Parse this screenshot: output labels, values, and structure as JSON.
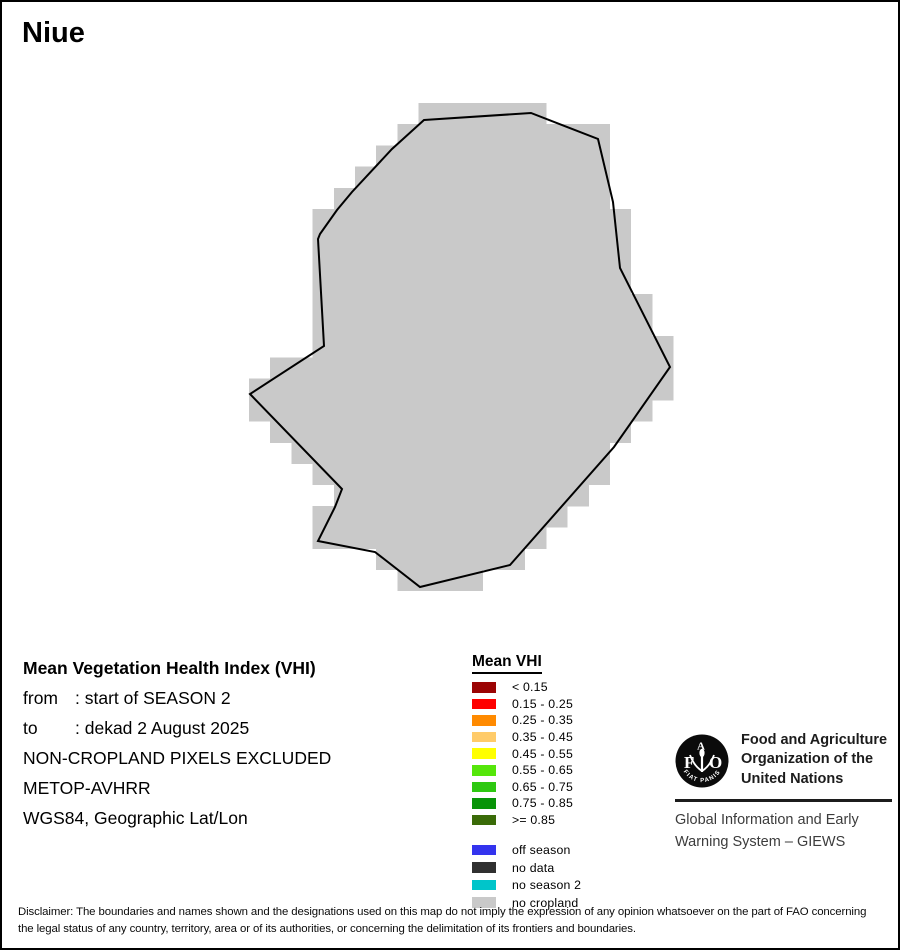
{
  "title": "Niue",
  "map": {
    "region_name": "Niue",
    "fill_color": "#C9C9C9",
    "outline_color": "#000000",
    "raster": {
      "cell_size": 21.2,
      "origin_x": 13.8,
      "origin_y": 16.2,
      "dilation": 7.5
    },
    "outline_points": [
      [
        422,
        118
      ],
      [
        529,
        111
      ],
      [
        596,
        137
      ],
      [
        611,
        200
      ],
      [
        618,
        266
      ],
      [
        668,
        365
      ],
      [
        612,
        445
      ],
      [
        508,
        563
      ],
      [
        418,
        585
      ],
      [
        373,
        550
      ],
      [
        316,
        539
      ],
      [
        333,
        505
      ],
      [
        340,
        487
      ],
      [
        248,
        392
      ],
      [
        322,
        344
      ],
      [
        316,
        237
      ],
      [
        318,
        232
      ],
      [
        335,
        208
      ],
      [
        350,
        190
      ],
      [
        390,
        147
      ]
    ]
  },
  "info": {
    "heading": "Mean Vegetation Health Index (VHI)",
    "rows": [
      {
        "label": "from",
        "value": ": start of SEASON 2"
      },
      {
        "label": "to",
        "value": ": dekad 2 August 2025"
      },
      {
        "label": "",
        "value": "NON-CROPLAND PIXELS EXCLUDED"
      },
      {
        "label": "",
        "value": "METOP-AVHRR"
      },
      {
        "label": "",
        "value": "WGS84, Geographic Lat/Lon"
      }
    ]
  },
  "legend": {
    "title": "Mean VHI",
    "classes": [
      {
        "label": "< 0.15",
        "color": "#9B0404"
      },
      {
        "label": "0.15 - 0.25",
        "color": "#FE0000"
      },
      {
        "label": "0.25 - 0.35",
        "color": "#FF8A00"
      },
      {
        "label": "0.35 - 0.45",
        "color": "#FFCB69"
      },
      {
        "label": "0.45 - 0.55",
        "color": "#FFFF00"
      },
      {
        "label": "0.55 - 0.65",
        "color": "#55E60A"
      },
      {
        "label": "0.65 - 0.75",
        "color": "#2EC811"
      },
      {
        "label": "0.75 - 0.85",
        "color": "#089408"
      },
      {
        "label": ">= 0.85",
        "color": "#3A6B08"
      }
    ],
    "special_classes": [
      {
        "label": "off season",
        "color": "#3333EE"
      },
      {
        "label": "no data",
        "color": "#303030"
      },
      {
        "label": "no season 2",
        "color": "#00C5CA"
      },
      {
        "label": "no cropland",
        "color": "#C9C9C9"
      }
    ]
  },
  "footer": {
    "fao_name_lines": [
      "Food and Agriculture",
      "Organization of the",
      "United Nations"
    ],
    "giews_lines": [
      "Global Information and Early",
      "Warning System – GIEWS"
    ],
    "fao_seal_letters": [
      "F",
      "A",
      "O"
    ],
    "fao_seal_motto": "FIAT  PANIS"
  },
  "disclaimer": "Disclaimer: The boundaries and names shown and the designations used on this map do not imply the expression of any opinion whatsoever on the part of FAO concerning the legal status of any country, territory, area or of its authorities, or concerning the delimitation of its frontiers and boundaries."
}
